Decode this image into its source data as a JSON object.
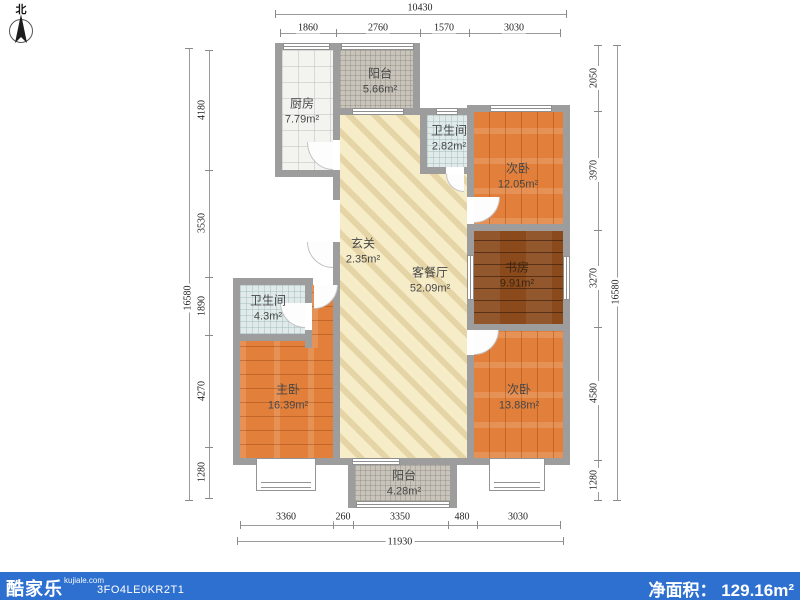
{
  "compass": {
    "label": "北"
  },
  "rooms": {
    "kitchen": {
      "name": "厨房",
      "area": "7.79m²"
    },
    "balcony_top": {
      "name": "阳台",
      "area": "5.66m²"
    },
    "bath_top": {
      "name": "卫生间",
      "area": "2.82m²"
    },
    "bedroom_tr": {
      "name": "次卧",
      "area": "12.05m²"
    },
    "study": {
      "name": "书房",
      "area": "9.91m²"
    },
    "hallway": {
      "name": "玄关",
      "area": "2.35m²"
    },
    "living": {
      "name": "客餐厅",
      "area": "52.09m²"
    },
    "bath_left": {
      "name": "卫生间",
      "area": "4.3m²"
    },
    "master": {
      "name": "主卧",
      "area": "16.39m²"
    },
    "bedroom_br": {
      "name": "次卧",
      "area": "13.88m²"
    },
    "balcony_bottom": {
      "name": "阳台",
      "area": "4.28m²"
    }
  },
  "dimensions": {
    "top_total": "10430",
    "top_segments": [
      "1860",
      "2760",
      "1570",
      "3030"
    ],
    "bottom_segments": [
      "3360",
      "260",
      "3350",
      "480",
      "3030"
    ],
    "bottom_total": "11930",
    "left_segments": [
      "4180",
      "3530",
      "1890",
      "4270",
      "1280"
    ],
    "left_total": "16580",
    "right_segments": [
      "2050",
      "3970",
      "3270",
      "4580",
      "1280"
    ],
    "right_total": "16580"
  },
  "footer": {
    "brand": "酷家乐",
    "website": "kujiale.com",
    "code": "3FO4LE0KR2T1",
    "area_label": "净面积：",
    "area_value": "129.16m²"
  },
  "colors": {
    "footer_bar": "#2e70d0",
    "wall": "#9d9d9d",
    "wood_floor": "#e2803b",
    "dark_wood_floor": "#8a4a1c",
    "living_floor": "#f6ecc8"
  }
}
